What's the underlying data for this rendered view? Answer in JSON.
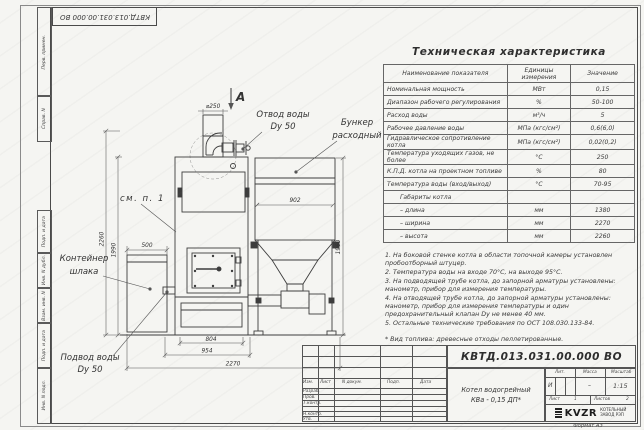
{
  "frame": {
    "margin_labels": [
      "Перв. примен.",
      "Справ. N",
      "Подп. и дата",
      "Инв. N дубл.",
      "Взам. инв. N",
      "Подп. и дата",
      "Инв. N подл."
    ],
    "format_note": "Формат А3"
  },
  "tech_table": {
    "title": "Техническая характеристика",
    "headers": [
      "Наименование показателя",
      "Единицы измерения",
      "Значение"
    ],
    "rows": [
      [
        "Номинальная мощность",
        "МВт",
        "0,15"
      ],
      [
        "Диапазон рабочего регулирования",
        "%",
        "50-100"
      ],
      [
        "Расход воды",
        "м³/ч",
        "5"
      ],
      [
        "Рабочее давление воды",
        "МПа (кгс/см²)",
        "0,6(6,0)"
      ],
      [
        "Гидравлическое сопротивление котла",
        "МПа (кгс/см²)",
        "0,02(0,2)"
      ],
      [
        "Температура уходящих газов, не более",
        "°С",
        "250"
      ],
      [
        "К.П.Д. котла на проектном топливе",
        "%",
        "80"
      ],
      [
        "Температура воды (вход/выход)",
        "°С",
        "70-95"
      ],
      [
        "Габариты котла",
        "",
        ""
      ],
      [
        "– длина",
        "мм",
        "1380"
      ],
      [
        "– ширина",
        "мм",
        "2270"
      ],
      [
        "– высота",
        "мм",
        "2260"
      ]
    ]
  },
  "notes": {
    "items": [
      "1. На боковой стенке котла в области топочной камеры установлен пробоотборный штуцер.",
      "2. Температура воды на входе 70°С, на выходе 95°С.",
      "3. На подводящей трубе котла, до запорной арматуры установлены: манометр, прибор для измерения температуры.",
      "4. На отводящей трубе котла, до запорной арматуры установлены: манометр, прибор для измерения температуры и один предохранительный клапан Dу не менее 40 мм.",
      "5. Остальные технические требования по ОСТ 108.030.133-84.",
      "* Вид топлива: древесные отходы пеллетированные."
    ]
  },
  "drawing": {
    "view_label": "А",
    "dims": {
      "chimney": "⌀250",
      "hopper_w": "902",
      "hopper_h": "1960",
      "total_h": "2260",
      "boiler_h": "1990",
      "slag_w": "500",
      "door_w": "804",
      "base_w": "954",
      "total_w": "2270"
    },
    "labels": {
      "see_note": "см. п. 1",
      "outlet1": "Отвод воды",
      "outlet2": "Dy 50",
      "hopper1": "Бункер",
      "hopper2": "расходный",
      "slag1": "Контейнер",
      "slag2": "шлака",
      "inlet1": "Подвод воды",
      "inlet2": "Dy 50"
    }
  },
  "title_block": {
    "doc_number": "КВТД.013.031.00.000 ВО",
    "product_name_1": "Котел водогрейный",
    "product_name_2": "КВа - 0,15  ДП*",
    "header_cols": [
      "Изм.",
      "Лист",
      "N докум.",
      "Подп.",
      "Дата"
    ],
    "role_rows": [
      "Разраб.",
      "Пров.",
      "Т.контр.",
      "",
      "Н.контр.",
      "Утв."
    ],
    "lit_label": "Лит.",
    "mass_label": "Масса",
    "scale_label": "Масштаб",
    "lit_value": "И",
    "mass_value": "–",
    "scale_value": "1:15",
    "sheet_label": "Лист",
    "sheet_value": "1",
    "sheets_label": "Листов",
    "sheets_value": "2",
    "company_logo": "KVZR",
    "company_name_1": "КОТЕЛЬНЫЙ",
    "company_name_2": "ЗАВОД РЭП"
  }
}
